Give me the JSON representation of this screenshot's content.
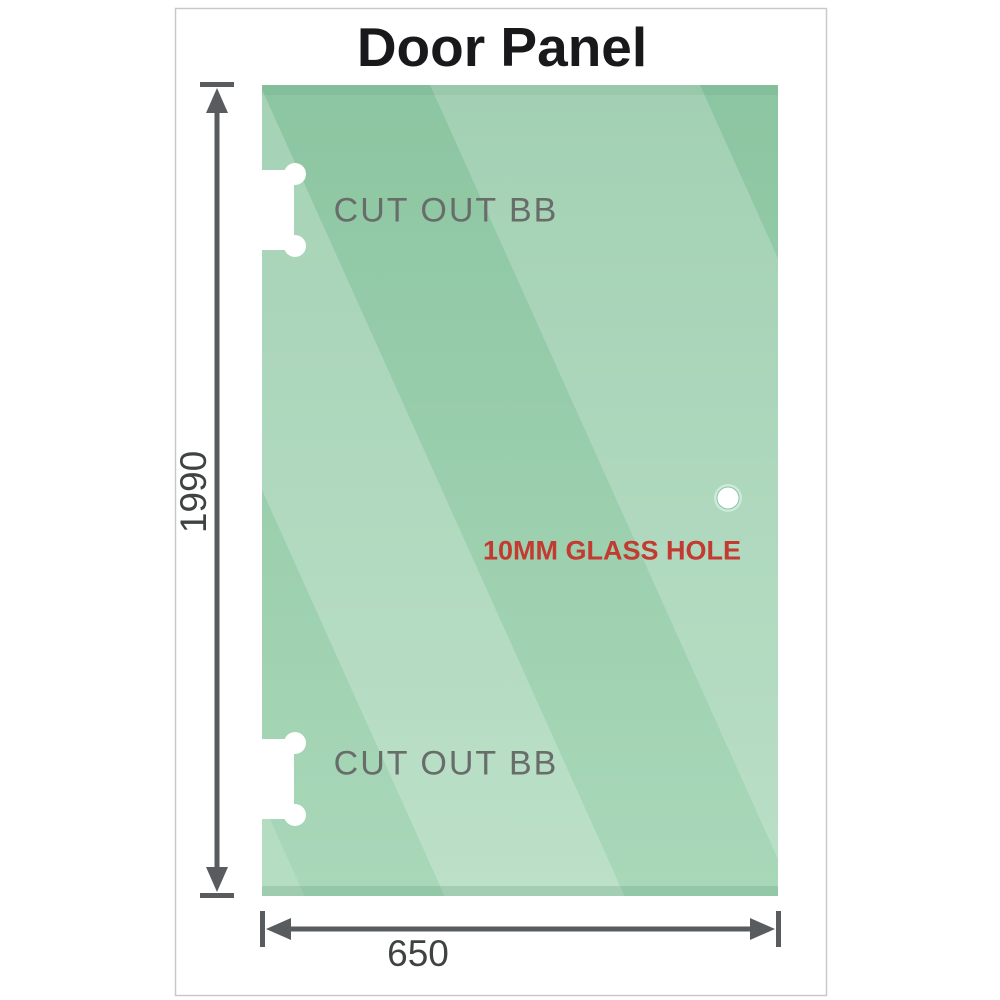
{
  "title": "Door Panel",
  "diagram": {
    "cutouts": [
      {
        "label": "CUT OUT BB"
      },
      {
        "label": "CUT OUT BB"
      }
    ],
    "hole": {
      "label": "10MM GLASS HOLE"
    },
    "dimensions": {
      "height": "1990",
      "width": "650"
    }
  },
  "colors": {
    "glass_top": "#8cc5a1",
    "glass_bottom": "#a9d8b9",
    "dimension": "#595c5e",
    "cutout_label": "#686d6a",
    "hole_label": "#c23a30",
    "title": "#19191b",
    "border": "#c9c9c9"
  }
}
